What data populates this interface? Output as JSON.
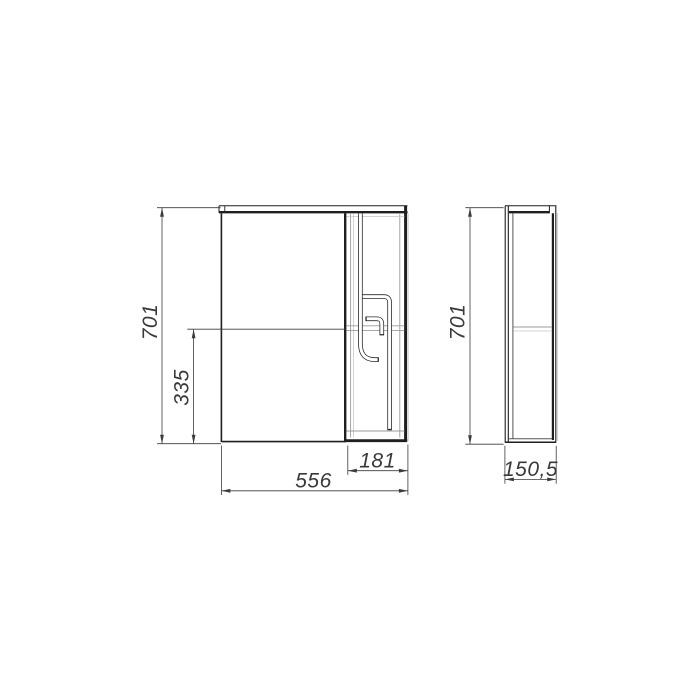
{
  "colors": {
    "background": "#ffffff",
    "line_main": "#1f1f1f",
    "line_secondary": "#9b9b9b",
    "dimension_lines": "#3c3c3c",
    "dimension_text": "#3a3a3a"
  },
  "front_view": {
    "height_label": "701",
    "partial_height_label": "335",
    "width_label": "556",
    "door_width_label": "181"
  },
  "side_view": {
    "height_label": "701",
    "depth_label": "150,5"
  }
}
